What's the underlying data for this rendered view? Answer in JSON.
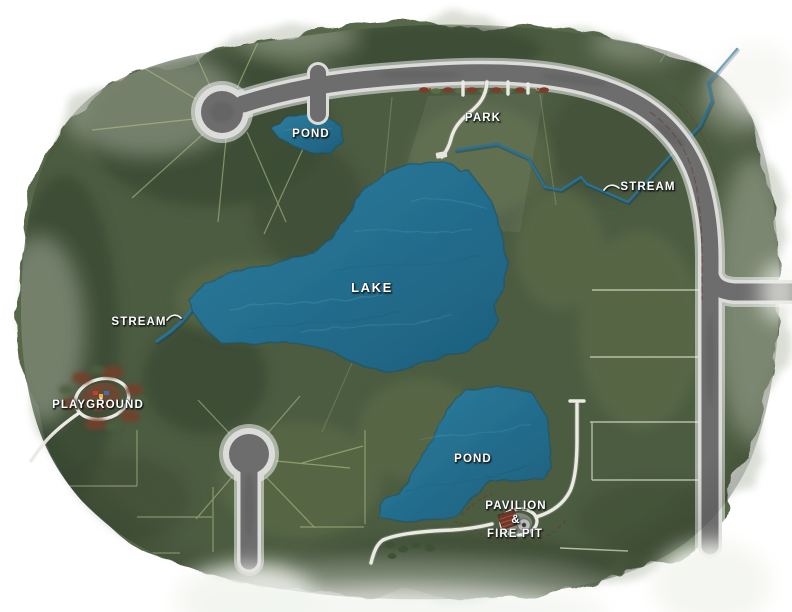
{
  "map": {
    "kind": "community-site-plan",
    "background": "#ffffff",
    "palette": {
      "grass": "#566849",
      "trees": "#42523a",
      "water": "#256e8e",
      "stream": "#2a7196",
      "road_asphalt": "#6d6d6d",
      "road_casing": "#dcdcda",
      "trail": "#eceae4",
      "lot_line": "#b5c08b",
      "planting_accent": "#7d3b2a",
      "label_text": "#ffffff"
    },
    "labels": {
      "lake": "LAKE",
      "pond_upper": "POND",
      "pond_lower": "POND",
      "park": "PARK",
      "stream_east": "STREAM",
      "stream_west": "STREAM",
      "playground": "PLAYGROUND",
      "pavilion_line1": "PAVILION",
      "pavilion_line2": "&",
      "pavilion_line3": "FIRE PIT"
    },
    "features": [
      {
        "name": "lake",
        "type": "water-body",
        "label": "LAKE"
      },
      {
        "name": "upper-pond",
        "type": "water-body",
        "label": "POND"
      },
      {
        "name": "lower-pond",
        "type": "water-body",
        "label": "POND"
      },
      {
        "name": "east-stream",
        "type": "stream",
        "label": "STREAM"
      },
      {
        "name": "west-stream",
        "type": "stream",
        "label": "STREAM"
      },
      {
        "name": "park",
        "type": "amenity",
        "label": "PARK"
      },
      {
        "name": "playground",
        "type": "amenity",
        "label": "PLAYGROUND"
      },
      {
        "name": "pavilion-fire-pit",
        "type": "amenity",
        "label": "PAVILION & FIRE PIT"
      },
      {
        "name": "north-road-with-cul-de-sac",
        "type": "road"
      },
      {
        "name": "east-loop-road",
        "type": "road"
      },
      {
        "name": "south-road-with-cul-de-sac",
        "type": "road"
      }
    ]
  }
}
